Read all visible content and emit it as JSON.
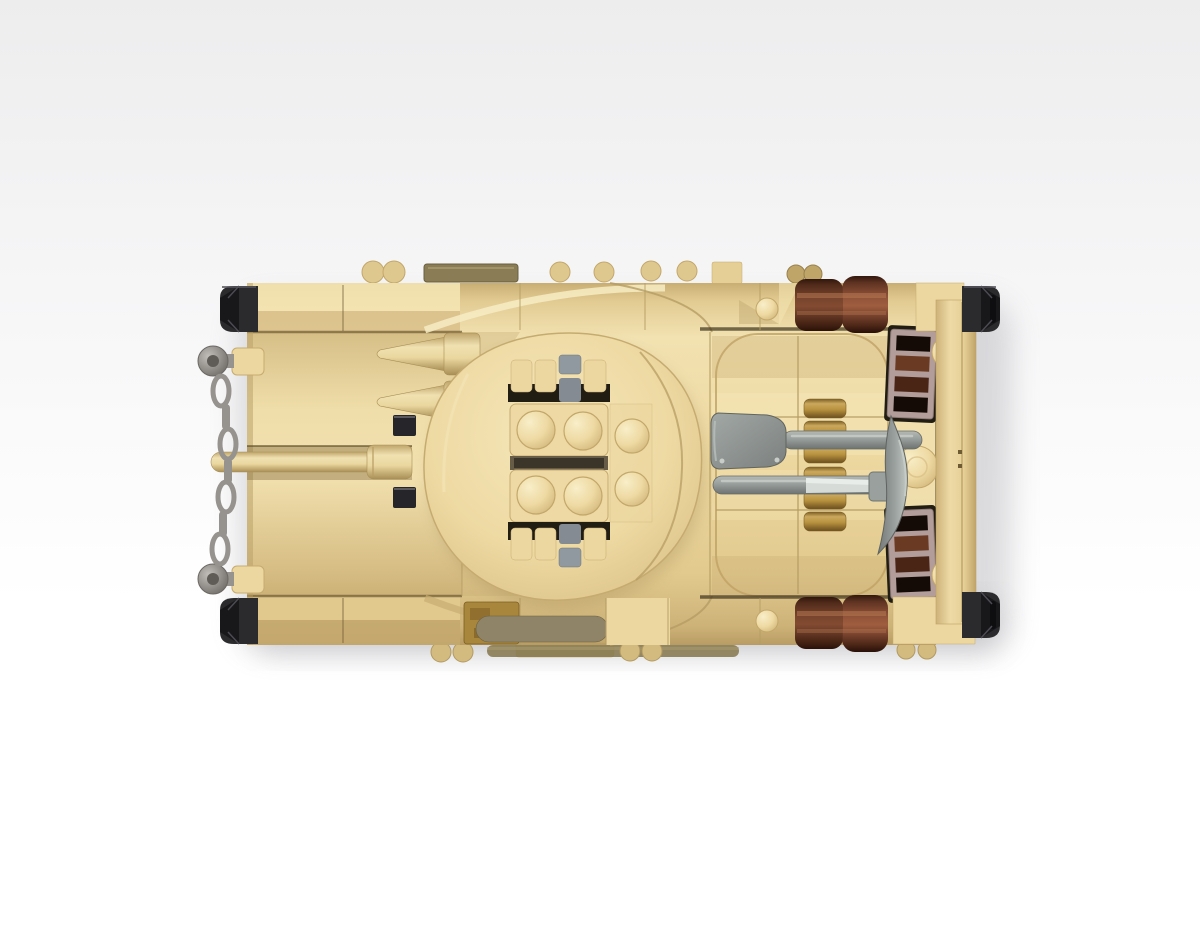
{
  "image": {
    "type": "3d-render",
    "subject": "Brick-built toy military armored vehicle seen from directly above",
    "orientation": "horizontal; front with tow chain and gun barrel at left, turret with twin hinged hatches in the middle, engine deck with tools at right",
    "background": "plain white-to-gray studio backdrop with soft shadow under the model"
  },
  "palette": {
    "background_top": "#eeeeef",
    "background_bottom": "#ffffff",
    "shadow": "#8f8f96",
    "tan": "#ecd7a0",
    "tan_light": "#f6e8bb",
    "tan_mid": "#e0c88d",
    "tan_dark": "#c9ad72",
    "tan_deep": "#a08851",
    "stud_edge": "#c3a76a",
    "seam": "#b59c63",
    "seam_dark": "#6e5a33",
    "gap_dark": "#221d13",
    "black_part": "#2b2b2e",
    "black_part_dark": "#18181b",
    "black_part_edge": "#4b4b52",
    "chain_gray": "#96928d",
    "pin_hole": "#5f5b56",
    "tool_gray": "#8e9492",
    "tool_gray_dark": "#666b68",
    "metal_bright": "#d7dbd8",
    "hinge_gray": "#9099a0",
    "hinge_gray_dark": "#848b93",
    "log_highlight": "#b97c54",
    "grille_frame": "#b29d9a",
    "grille_slot_black": "#140b07",
    "grille_slot_brown": "#6b3a22",
    "grille_slot_brown2": "#4a2515",
    "gold": "#b8923f",
    "gold_dark": "#7d5f26",
    "gold_tile": "#a8863b",
    "olive": "#8a7c54",
    "olive_dark": "#6b6040",
    "dark_tan_bar": "#8f8468",
    "stud_shaded": "#d3ba7f"
  },
  "elements": {
    "front_left": [
      "tow-chain",
      "chain-mounts",
      "gun-barrel",
      "cone-dischargers",
      "black-corner-guards",
      "periscope-tiles"
    ],
    "turret": [
      "hinged-hatch-top",
      "hinged-hatch-bottom",
      "hatch-studs",
      "round-side-studs",
      "hinge-pins"
    ],
    "engine_deck": [
      "shovel",
      "pickaxe",
      "gold-clip-rack",
      "brown-exhaust-logs",
      "vent-grilles",
      "filler-cap-dome",
      "corner-studs"
    ],
    "rear_right": [
      "end-plate",
      "black-corner-guards"
    ],
    "edges": [
      "top-edge-studs",
      "olive-tile",
      "bottom-edge-studs",
      "olive-rod",
      "gold-weathered-tile",
      "dark-tan-grab-bar"
    ]
  }
}
